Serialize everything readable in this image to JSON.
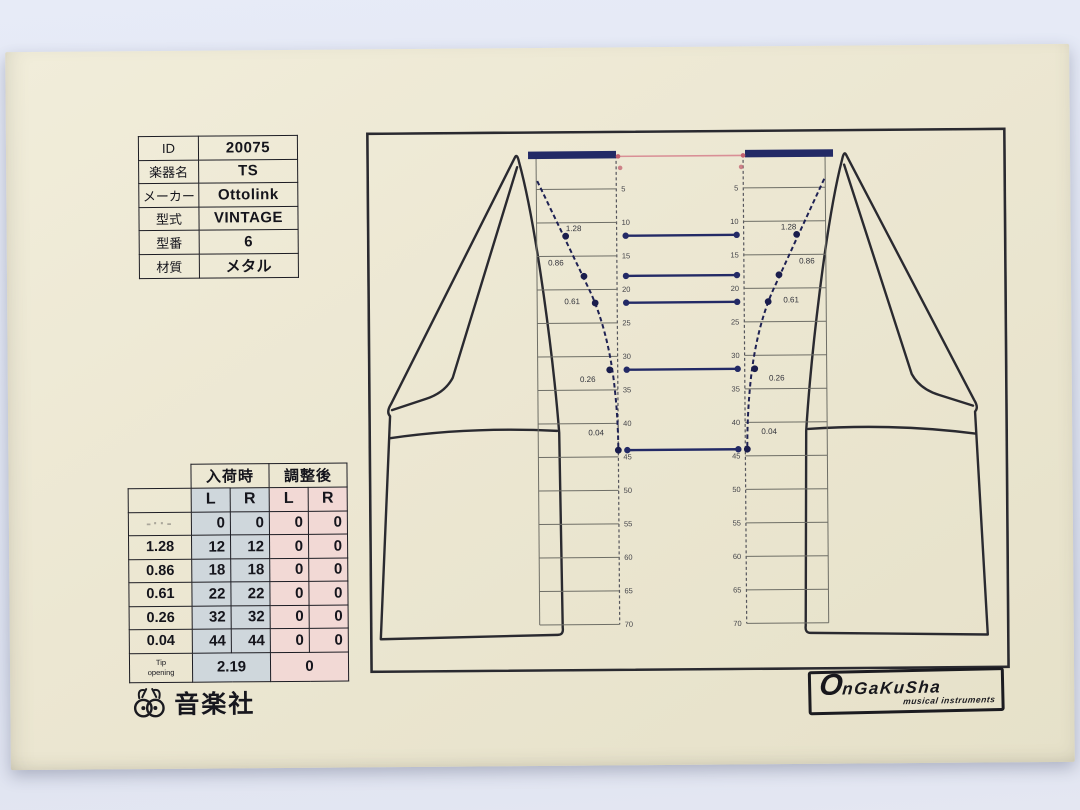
{
  "info_table": {
    "rows": [
      {
        "label": "ID",
        "value": "20075"
      },
      {
        "label": "楽器名",
        "value": "TS"
      },
      {
        "label": "メーカー",
        "value": "Ottolink"
      },
      {
        "label": "型式",
        "value": "VINTAGE"
      },
      {
        "label": "型番",
        "value": "6"
      },
      {
        "label": "材質",
        "value": "メタル"
      }
    ]
  },
  "measure_table": {
    "group_headers": [
      "入荷時",
      "調整後"
    ],
    "sub_headers": [
      "L",
      "R",
      "L",
      "R"
    ],
    "rows": [
      {
        "label": "-··-",
        "faint": true,
        "values": [
          "0",
          "0",
          "0",
          "0"
        ]
      },
      {
        "label": "1.28",
        "faint": false,
        "values": [
          "12",
          "12",
          "0",
          "0"
        ]
      },
      {
        "label": "0.86",
        "faint": false,
        "values": [
          "18",
          "18",
          "0",
          "0"
        ]
      },
      {
        "label": "0.61",
        "faint": false,
        "values": [
          "22",
          "22",
          "0",
          "0"
        ]
      },
      {
        "label": "0.26",
        "faint": false,
        "values": [
          "32",
          "32",
          "0",
          "0"
        ]
      },
      {
        "label": "0.04",
        "faint": false,
        "values": [
          "44",
          "44",
          "0",
          "0"
        ]
      }
    ],
    "tip_row": {
      "label": "Tip\nopening",
      "arrival_value": "2.19",
      "adjusted_value": "0"
    }
  },
  "diagram": {
    "ruler_ticks": [
      "5",
      "10",
      "15",
      "20",
      "25",
      "30",
      "35",
      "40",
      "45",
      "50",
      "55",
      "60",
      "65",
      "70"
    ],
    "gauge_values": [
      "1.28",
      "0.86",
      "0.61",
      "0.26",
      "0.04"
    ],
    "gauge_depths": [
      12,
      18,
      22,
      32,
      44
    ],
    "colors": {
      "navy": "#232a66",
      "pink_line": "#d98f96",
      "pink_marker": "#c2606f",
      "ink": "#2a2a30",
      "ruler_line": "#6e6e66"
    }
  },
  "logos": {
    "company_jp": "音楽社",
    "company_en_main": "OnGaKuSha",
    "company_en_sub": "musical instruments"
  }
}
